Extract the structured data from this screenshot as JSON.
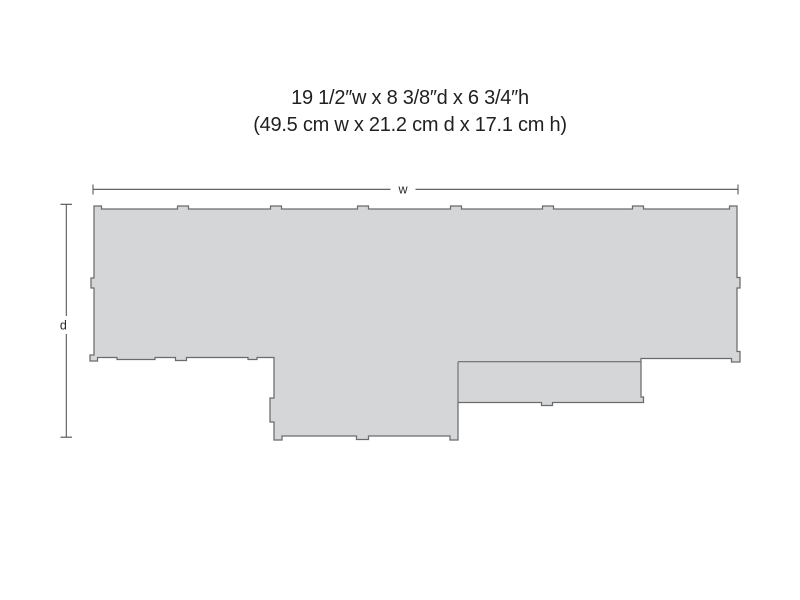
{
  "figure": {
    "dimensions_inches": "19 1/2″w x 8 3/8″d x 6 3/4″h",
    "dimensions_metric": "(49.5 cm w x 21.2 cm d x 17.1 cm h)"
  },
  "footprint": {
    "width_label": "w",
    "depth_label": "d",
    "fill_color": "#d4d6d7",
    "outline_color": "#696b6d",
    "dimension_line_color": "#515254",
    "text_color": "#1f2021"
  }
}
